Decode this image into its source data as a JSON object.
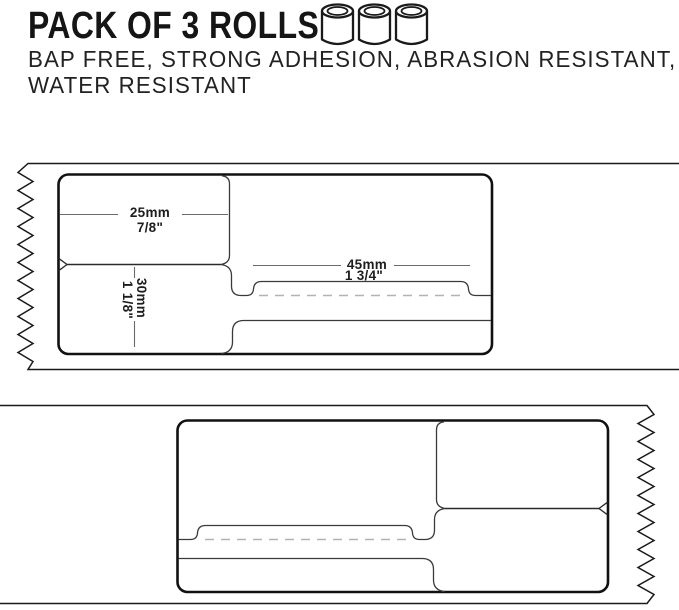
{
  "header": {
    "title": "PACK OF 3 ROLLS",
    "subtitle_line1": "BAP FREE, STRONG ADHESION, ABRASION RESISTANT,",
    "subtitle_line2": "WATER RESISTANT",
    "roll_icon_count": 3
  },
  "diagrams": {
    "top": {
      "width": {
        "mm": "25mm",
        "in": "7/8\""
      },
      "height": {
        "mm": "30mm",
        "in": "1 1/8\""
      },
      "length": {
        "mm": "45mm",
        "in": "1 3/4\""
      }
    },
    "bottom": {}
  },
  "colors": {
    "background": "#ffffff",
    "line": "#1a1a1a",
    "thin_line": "#3a3a3a",
    "dim_line": "#6a6a6a",
    "dash_line": "#b3b3b3",
    "text": "#151515"
  }
}
